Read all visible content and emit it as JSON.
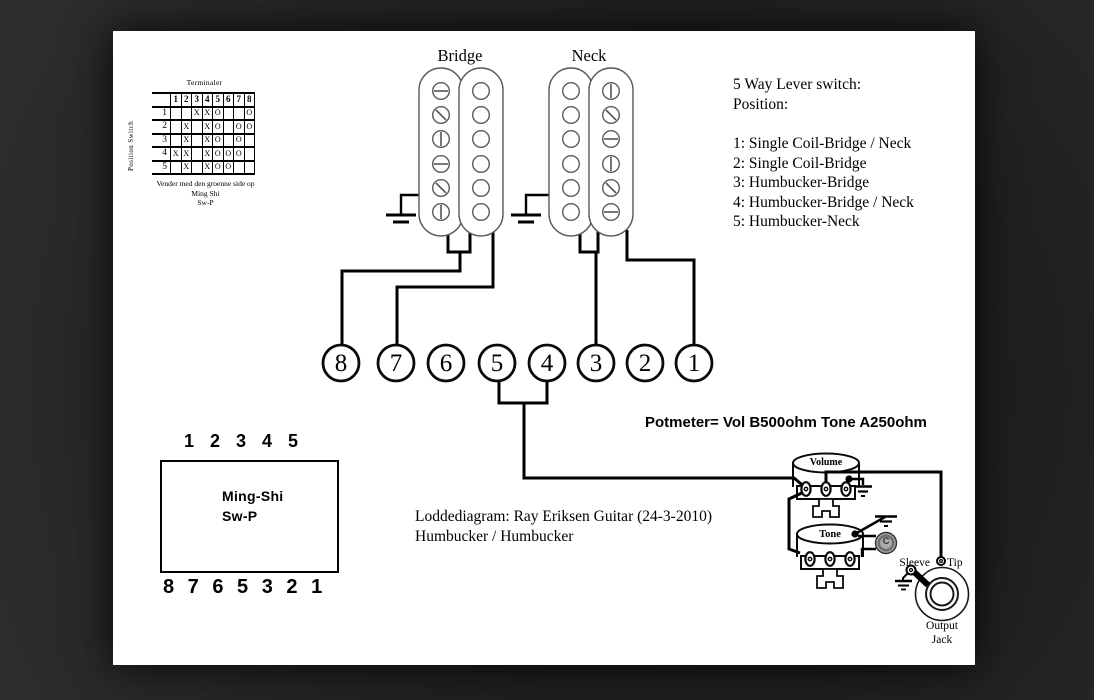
{
  "terminal_table": {
    "title": "Terminaler",
    "side_label": "Position Switch",
    "col_headers": [
      "1",
      "2",
      "3",
      "4",
      "5",
      "6",
      "7",
      "8"
    ],
    "rows": [
      {
        "label": "1",
        "cells": [
          "",
          "",
          "X",
          "X",
          "O",
          "",
          "",
          "O"
        ]
      },
      {
        "label": "2",
        "cells": [
          "",
          "X",
          "",
          "X",
          "O",
          "",
          "O",
          "O"
        ]
      },
      {
        "label": "3",
        "cells": [
          "",
          "X",
          "",
          "X",
          "O",
          "",
          "O",
          ""
        ]
      },
      {
        "label": "4",
        "cells": [
          "X",
          "X",
          "",
          "X",
          "O",
          "O",
          "O",
          ""
        ]
      },
      {
        "label": "5",
        "cells": [
          "",
          "X",
          "",
          "X",
          "O",
          "O",
          "",
          ""
        ]
      }
    ],
    "footer": [
      "Vender med den groenne side op",
      "Ming Shi",
      "Sw-P"
    ]
  },
  "pickups": {
    "bridge": "Bridge",
    "neck": "Neck"
  },
  "lever_switch": {
    "title": "5 Way Lever switch:",
    "subtitle": "Position:",
    "positions": [
      "1: Single Coil-Bridge / Neck",
      "2: Single Coil-Bridge",
      "3: Humbucker-Bridge",
      "4: Humbucker-Bridge / Neck",
      "5: Humbucker-Neck"
    ]
  },
  "terminals": [
    "8",
    "7",
    "6",
    "5",
    "4",
    "3",
    "2",
    "1"
  ],
  "pot_note": "Potmeter= Vol B500ohm Tone A250ohm",
  "switch_body": {
    "top_numbers": "1 2 3 4 5",
    "name": "Ming-Shi",
    "model": "Sw-P",
    "bottom_numbers": "8 7 6 5 3 2 1"
  },
  "caption": {
    "line1": "Loddediagram: Ray Eriksen Guitar (24-3-2010)",
    "line2": "Humbucker / Humbucker"
  },
  "controls": {
    "volume": "Volume",
    "tone": "Tone",
    "capacitor": "C",
    "sleeve": "Sleeve",
    "tip": "Tip",
    "jack_line1": "Output",
    "jack_line2": "Jack"
  },
  "colors": {
    "ink": "#000000",
    "paper": "#ffffff",
    "background": "#262626",
    "pickup_outline": "#5a5a5a",
    "capacitor_fill": "#ababab"
  }
}
